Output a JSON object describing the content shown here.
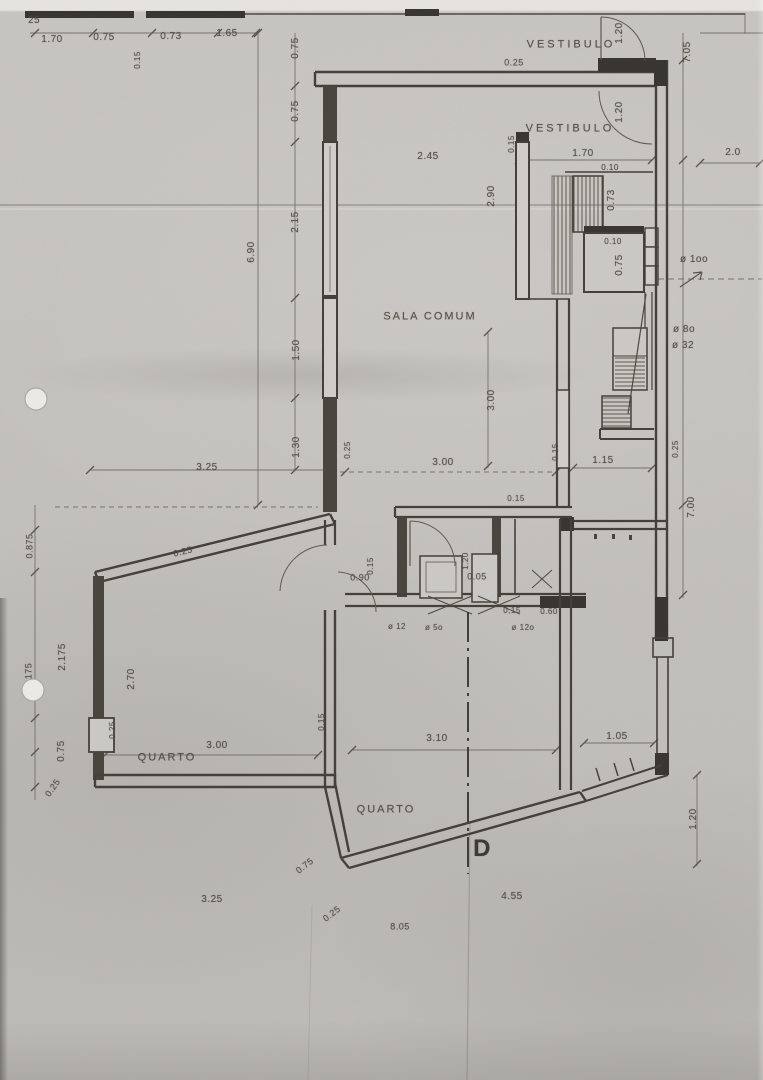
{
  "document": {
    "kind": "scanned architectural floor plan",
    "section_mark": "D"
  },
  "rooms": [
    {
      "id": "vestibulo-upper",
      "label": "VESTIBULO"
    },
    {
      "id": "vestibulo",
      "label": "VESTIBULO"
    },
    {
      "id": "sala-comum",
      "label": "SALA COMUM"
    },
    {
      "id": "quarto-left",
      "label": "QUARTO"
    },
    {
      "id": "quarto-center",
      "label": "QUARTO"
    }
  ],
  "pipe_diameters": [
    "ø 1oo",
    "ø 8o",
    "ø 32",
    "ø 12",
    "ø 5o",
    "ø 12o"
  ],
  "colors": {
    "paper": "#c6c4bf",
    "ink": "#4d4a42",
    "wall": "#403d36",
    "wall_fill": "#34322d"
  },
  "labels": [
    {
      "id": "dim-25-cut",
      "text": "25",
      "x": 34,
      "y": 21,
      "s": 10
    },
    {
      "id": "dim-170-top",
      "text": "1.70",
      "x": 52,
      "y": 40
    },
    {
      "id": "dim-075-top",
      "text": "0.75",
      "x": 104,
      "y": 38
    },
    {
      "id": "dim-073-top",
      "text": "0.73",
      "x": 171,
      "y": 37
    },
    {
      "id": "dim-165-top",
      "text": "1.65",
      "x": 227,
      "y": 34
    },
    {
      "id": "dim-015-topwall",
      "text": "0.15",
      "x": 138,
      "y": 60,
      "r": -90,
      "s": 8
    },
    {
      "id": "dim-075-leftchain-a",
      "text": "0.75",
      "x": 296,
      "y": 48,
      "r": -90
    },
    {
      "id": "dim-075-leftchain-b",
      "text": "0.75",
      "x": 296,
      "y": 111,
      "r": -90
    },
    {
      "id": "room-vestibulo-upper",
      "text": "VESTIBULO",
      "x": 571,
      "y": 45,
      "ls": 3,
      "s": 11
    },
    {
      "id": "dim-120-door-top",
      "text": "1.20",
      "x": 620,
      "y": 33,
      "r": -90
    },
    {
      "id": "dim-705-right",
      "text": "7.05",
      "x": 688,
      "y": 52,
      "r": -90
    },
    {
      "id": "dim-025-topwall",
      "text": "0.25",
      "x": 514,
      "y": 63,
      "s": 9
    },
    {
      "id": "room-vestibulo",
      "text": "VESTIBULO",
      "x": 570,
      "y": 129,
      "ls": 3,
      "s": 11
    },
    {
      "id": "dim-120-door-vest",
      "text": "1.20",
      "x": 620,
      "y": 112,
      "r": -90
    },
    {
      "id": "dim-245",
      "text": "2.45",
      "x": 428,
      "y": 157
    },
    {
      "id": "dim-015-wall-a",
      "text": "0.15",
      "x": 512,
      "y": 144,
      "r": -90,
      "s": 8
    },
    {
      "id": "dim-170-vest",
      "text": "1.70",
      "x": 583,
      "y": 154
    },
    {
      "id": "dim-20-right",
      "text": "2.0",
      "x": 733,
      "y": 153
    },
    {
      "id": "dim-010-a",
      "text": "0.10",
      "x": 610,
      "y": 168,
      "s": 8
    },
    {
      "id": "dim-290",
      "text": "2.90",
      "x": 492,
      "y": 196,
      "r": -90
    },
    {
      "id": "dim-073-shaft",
      "text": "0.73",
      "x": 612,
      "y": 200,
      "r": -90
    },
    {
      "id": "dim-215-left",
      "text": "2.15",
      "x": 296,
      "y": 222,
      "r": -90
    },
    {
      "id": "dim-690-left",
      "text": "6.90",
      "x": 252,
      "y": 252,
      "r": -90
    },
    {
      "id": "dim-010-b",
      "text": "0.10",
      "x": 613,
      "y": 242,
      "s": 8
    },
    {
      "id": "dim-075-shaft",
      "text": "0.75",
      "x": 620,
      "y": 265,
      "r": -90
    },
    {
      "id": "note-phi100",
      "text": "ø 1oo",
      "x": 694,
      "y": 260,
      "s": 10
    },
    {
      "id": "room-sala-comum",
      "text": "SALA COMUM",
      "x": 430,
      "y": 317,
      "ls": 2,
      "s": 11
    },
    {
      "id": "note-phi80",
      "text": "ø 8o",
      "x": 684,
      "y": 330
    },
    {
      "id": "note-phi32",
      "text": "ø 32",
      "x": 683,
      "y": 346
    },
    {
      "id": "dim-150-left",
      "text": "1.50",
      "x": 297,
      "y": 350,
      "r": -90
    },
    {
      "id": "dim-300-sala-v",
      "text": "3.00",
      "x": 492,
      "y": 400,
      "r": -90
    },
    {
      "id": "dim-130-left",
      "text": "1.30",
      "x": 297,
      "y": 447,
      "r": -90
    },
    {
      "id": "dim-025-sala",
      "text": "0.25",
      "x": 348,
      "y": 450,
      "r": -90,
      "s": 8
    },
    {
      "id": "dim-015-sala",
      "text": "0.15",
      "x": 556,
      "y": 452,
      "r": -90,
      "s": 8
    },
    {
      "id": "dim-025-right",
      "text": "0.25",
      "x": 676,
      "y": 449,
      "r": -90,
      "s": 8
    },
    {
      "id": "dim-325-mid",
      "text": "3.25",
      "x": 207,
      "y": 468
    },
    {
      "id": "dim-300-sala-h",
      "text": "3.00",
      "x": 443,
      "y": 463
    },
    {
      "id": "dim-115",
      "text": "1.15",
      "x": 603,
      "y": 461
    },
    {
      "id": "dim-015-bath-top",
      "text": "0.15",
      "x": 516,
      "y": 499,
      "s": 8
    },
    {
      "id": "dim-700-right",
      "text": "7.00",
      "x": 692,
      "y": 507,
      "r": -90
    },
    {
      "id": "dim-0875-left",
      "text": "0.875",
      "x": 30,
      "y": 546,
      "r": -90,
      "s": 9
    },
    {
      "id": "dim-025-diag",
      "text": "0.25",
      "x": 183,
      "y": 552,
      "r": -14,
      "s": 9
    },
    {
      "id": "dim-015-bath",
      "text": "0.15",
      "x": 371,
      "y": 566,
      "r": -90,
      "s": 8
    },
    {
      "id": "dim-090",
      "text": "0.90",
      "x": 360,
      "y": 578,
      "s": 9
    },
    {
      "id": "dim-120-bath",
      "text": "1.20",
      "x": 466,
      "y": 561,
      "r": -90,
      "s": 8
    },
    {
      "id": "dim-005-bath",
      "text": "0.05",
      "x": 477,
      "y": 577,
      "s": 9
    },
    {
      "id": "dim-015-bath-b",
      "text": "0,15",
      "x": 512,
      "y": 611,
      "s": 8
    },
    {
      "id": "dim-060",
      "text": "0.60",
      "x": 549,
      "y": 612,
      "s": 8
    },
    {
      "id": "note-phi12",
      "text": "ø 12",
      "x": 397,
      "y": 627,
      "s": 8
    },
    {
      "id": "note-phi50",
      "text": "ø 5o",
      "x": 434,
      "y": 628,
      "s": 8
    },
    {
      "id": "note-phi120",
      "text": "ø 12o",
      "x": 523,
      "y": 628,
      "s": 8
    },
    {
      "id": "dim-2175-left",
      "text": "2.175",
      "x": 63,
      "y": 657,
      "r": -90
    },
    {
      "id": "dim-175-edge",
      "text": "175",
      "x": 29,
      "y": 671,
      "r": -90,
      "s": 9
    },
    {
      "id": "dim-270-quarto",
      "text": "2.70",
      "x": 132,
      "y": 679,
      "r": -90
    },
    {
      "id": "dim-025-closet",
      "text": "0.25",
      "x": 113,
      "y": 730,
      "r": -90,
      "s": 8
    },
    {
      "id": "dim-300-quarto",
      "text": "3.00",
      "x": 217,
      "y": 746
    },
    {
      "id": "dim-015-quarto",
      "text": "0.15",
      "x": 322,
      "y": 722,
      "r": -90,
      "s": 8
    },
    {
      "id": "dim-075-left-b",
      "text": "0.75",
      "x": 62,
      "y": 751,
      "r": -90
    },
    {
      "id": "room-quarto-left",
      "text": "QUARTO",
      "x": 167,
      "y": 758,
      "ls": 2,
      "s": 11
    },
    {
      "id": "dim-310",
      "text": "3.10",
      "x": 437,
      "y": 739
    },
    {
      "id": "dim-105",
      "text": "1.05",
      "x": 617,
      "y": 737
    },
    {
      "id": "dim-025-left-c",
      "text": "0.25",
      "x": 53,
      "y": 788,
      "r": -55,
      "s": 9
    },
    {
      "id": "room-quarto-center",
      "text": "QUARTO",
      "x": 386,
      "y": 810,
      "ls": 2,
      "s": 11
    },
    {
      "id": "section-mark-d",
      "text": "D",
      "x": 482,
      "y": 849,
      "s": 24,
      "bold": true
    },
    {
      "id": "dim-120-right-b",
      "text": "1.20",
      "x": 694,
      "y": 819,
      "r": -90
    },
    {
      "id": "dim-075-diag-b",
      "text": "0.75",
      "x": 305,
      "y": 866,
      "r": -38,
      "s": 9
    },
    {
      "id": "dim-325-bottom",
      "text": "3.25",
      "x": 212,
      "y": 900
    },
    {
      "id": "dim-025-diag-c",
      "text": "0.25",
      "x": 332,
      "y": 914,
      "r": -38,
      "s": 9
    },
    {
      "id": "dim-455-bottom",
      "text": "4.55",
      "x": 512,
      "y": 897
    },
    {
      "id": "dim-805-bottom",
      "text": "8.05",
      "x": 400,
      "y": 927,
      "s": 9
    }
  ]
}
